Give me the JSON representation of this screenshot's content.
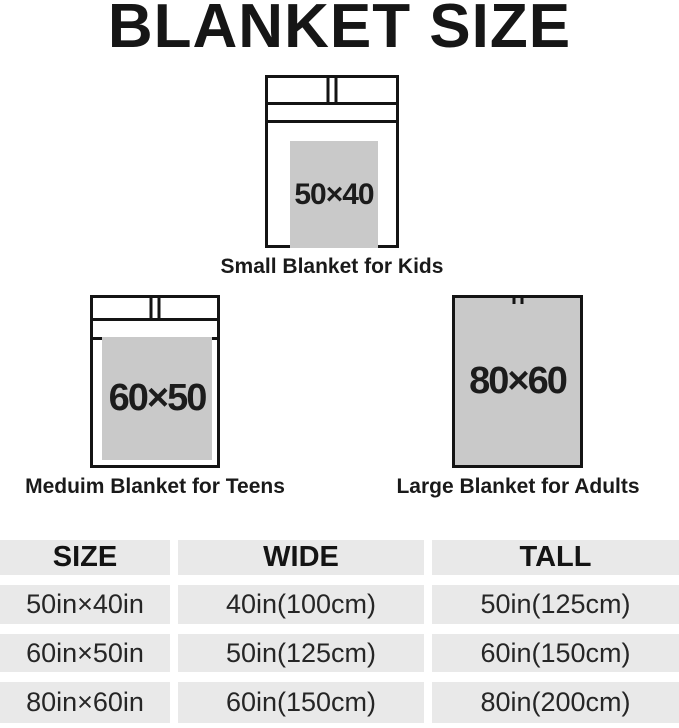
{
  "title": "BLANKET SIZE",
  "figures": [
    {
      "size": "50×40",
      "caption": "Small Blanket for Kids"
    },
    {
      "size": "60×50",
      "caption": "Meduim Blanket for Teens"
    },
    {
      "size": "80×60",
      "caption": "Large Blanket for Adults"
    }
  ],
  "table": {
    "headers": [
      "SIZE",
      "WIDE",
      "TALL"
    ],
    "rows": [
      [
        "50in×40in",
        "40in(100cm)",
        "50in(125cm)"
      ],
      [
        "60in×50in",
        "50in(125cm)",
        "60in(150cm)"
      ],
      [
        "80in×60in",
        "60in(150cm)",
        "80in(200cm)"
      ]
    ]
  },
  "colors": {
    "blanket_fill": "#c9c9c9",
    "table_cell": "#e9e9e9",
    "outline": "#141414"
  }
}
